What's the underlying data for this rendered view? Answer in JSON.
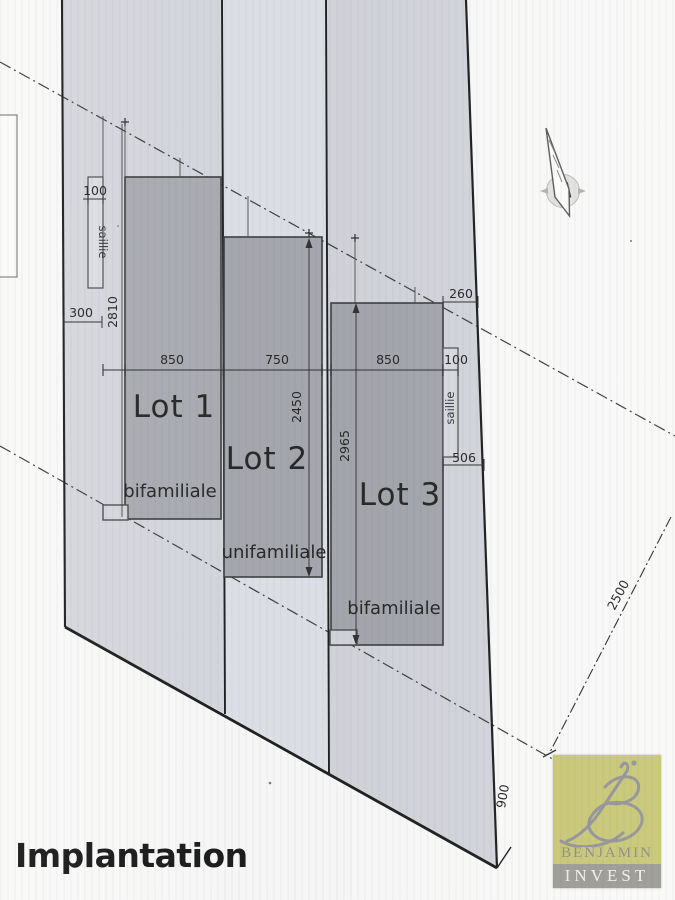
{
  "title": "Implantation",
  "compass": {
    "north_label": "N"
  },
  "logo": {
    "brand": "BENJAMIN",
    "division": "INVEST",
    "bg_color": "#c9c877",
    "band_color": "#9d9d95",
    "monogram_color": "#94949a"
  },
  "plan": {
    "lots": [
      {
        "name": "Lot 1",
        "building_type": "bifamiliale",
        "width_cm": "850",
        "depth_cm": "2810",
        "side_offset_cm": "300",
        "saillie": {
          "label": "saillie",
          "width_cm": "100"
        }
      },
      {
        "name": "Lot 2",
        "building_type": "unifamiliale",
        "width_cm": "750",
        "depth_cm": "2450"
      },
      {
        "name": "Lot 3",
        "building_type": "bifamiliale",
        "width_cm": "850",
        "depth_cm": "2965",
        "corner_offset_cm": "260",
        "saillie": {
          "label": "saillie",
          "width_cm": "100",
          "offset_cm": "506"
        }
      }
    ],
    "site_dimensions": {
      "east_boundary_cm": "2500",
      "south_boundary_cm": "900"
    }
  },
  "colors": {
    "parcel": "#d5d7dc",
    "parcel_light": "#dfe1e7",
    "building": "#a8aaae"
  }
}
